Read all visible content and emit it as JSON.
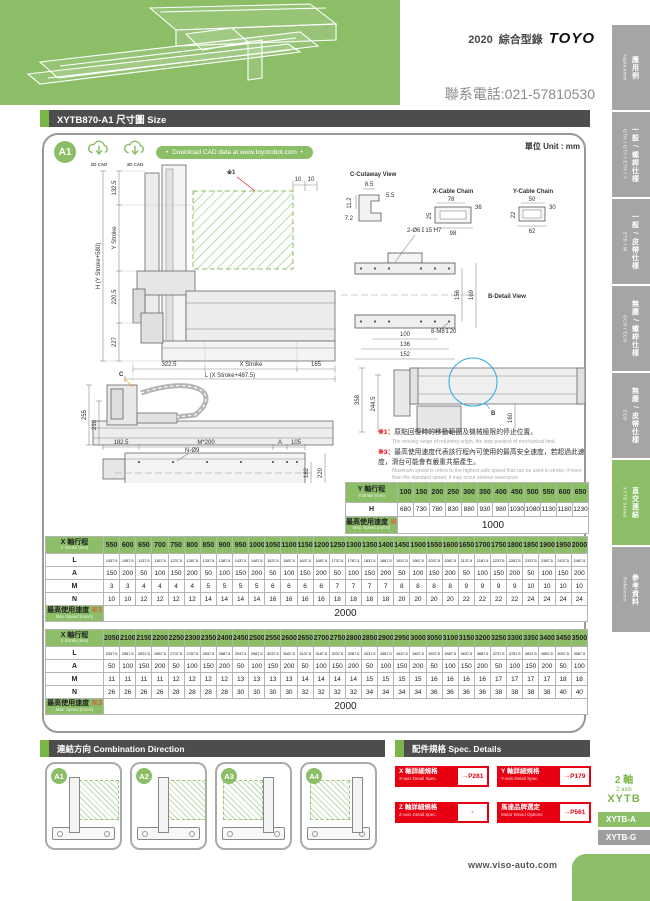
{
  "page": {
    "brand_year": "2020",
    "brand_catalog": "綜合型錄",
    "brand_logo": "TOYO",
    "phone": "聯系電話:021-57810530",
    "footer_url": "www.viso-auto.com"
  },
  "header": {
    "title": "XYTB870-A1 尺寸圖 Size",
    "unit": "單位 Unit : mm",
    "model_badge": "A1",
    "cad_2d": "2D CAD",
    "cad_3d": "3D CAD",
    "download_pill": "Download CAD data at www.toyorobot.com"
  },
  "sidebar": {
    "tabs": [
      {
        "zh": "應用例",
        "en": "Application",
        "active": false
      },
      {
        "zh": "一般 / 螺桿仕樣",
        "en": "GTH / GTY / ETH / Y",
        "active": false
      },
      {
        "zh": "一般 / 皮帶仕樣",
        "en": "ETB / M",
        "active": false
      },
      {
        "zh": "無塵 / 螺桿仕樣",
        "en": "GCH / ECH",
        "active": false
      },
      {
        "zh": "無塵 / 皮帶仕樣",
        "en": "ECB",
        "active": false
      },
      {
        "zh": "直交連結",
        "en": "XYTB Series",
        "active": true
      },
      {
        "zh": "參考資料",
        "en": "Reference",
        "active": false
      }
    ],
    "series_badge": {
      "axis_zh": "2 軸",
      "axis_en": "2 axis",
      "series": "XYTB"
    },
    "series_tabs": [
      {
        "label": "XYTB-A",
        "active": true
      },
      {
        "label": "XYTB-G",
        "active": false
      }
    ]
  },
  "drawings": {
    "front": {
      "ref1": "※1",
      "d10a": "10",
      "d10b": "10",
      "d1325": "132.5",
      "y_stroke": "Y Stroke",
      "h_total": "H (Y Stroke+580)",
      "d2205": "220.5",
      "d227": "227",
      "d3225": "322.5",
      "x_stroke": "X Stroke",
      "d165": "165",
      "l_total": "L (X Stroke+487.5)"
    },
    "cutaway": {
      "title": "C-Cutaway View",
      "d85": "8.5",
      "d55": "5.5",
      "d112": "11.2",
      "d72": "7.2"
    },
    "xchain": {
      "title": "X-Cable Chain",
      "d78": "78",
      "d36": "36",
      "d25": "25",
      "d98": "98"
    },
    "ychain": {
      "title": "Y-Cable Chain",
      "d50": "50",
      "d30": "30",
      "d22": "22",
      "d62": "62"
    },
    "bdetail": {
      "title": "B-Detail View",
      "holes_top": "2-Ø6↧15 H7",
      "holes_bottom": "8-M8↧20",
      "d156": "156",
      "d169": "169",
      "d100": "100",
      "d136": "136",
      "d152": "152"
    },
    "side": {
      "ref": "C",
      "d255": "255",
      "d210": "210"
    },
    "top": {
      "d1825": "182.5",
      "m200a": "M*200",
      "aa": "A",
      "d105": "105",
      "holes_top": "N-Ø9",
      "d182": "182",
      "d220": "220",
      "d2025": "202.5",
      "holes_bottom": "N-M10↧16",
      "m200b": "M*200",
      "ab": "A",
      "d85": "85"
    },
    "sideb": {
      "ref": "B",
      "d358": "358",
      "d2445": "244.5",
      "d160": "160"
    }
  },
  "notes": [
    {
      "ref": "※1",
      "zh": "原點回復時的移動範圍及機械極限的停止位置。",
      "en": "The moving range of returning origin, the stop position of mechanical limit."
    },
    {
      "ref": "※3",
      "zh": "最高使用速度代表該行程內可使用的最高安全速度，若超過此速度，滑台可能會有嚴重共振產生。",
      "en": "Maximum speed is refers to the highest safe speed that can be used in stroke, if more than the standard speed, it may occur serious resonance."
    }
  ],
  "tables": {
    "y_table": {
      "header_zh": "Y 軸行程",
      "header_en": "YStroke (mm)",
      "strokes": [
        100,
        150,
        200,
        250,
        300,
        350,
        400,
        450,
        500,
        550,
        600,
        650
      ],
      "rows": [
        {
          "label": "H",
          "values": [
            680,
            730,
            780,
            830,
            880,
            930,
            980,
            1030,
            1080,
            1130,
            1180,
            1230
          ]
        }
      ],
      "speed_label_zh": "最高使用速度",
      "speed_note": "※3",
      "speed_label_en": "Max. Speed (mm/s)",
      "speed_value": "1000"
    },
    "x_table_1": {
      "header_zh": "X 軸行程",
      "header_en": "X Stroke (mm)",
      "strokes": [
        550,
        600,
        650,
        700,
        750,
        800,
        850,
        900,
        950,
        1000,
        1050,
        1100,
        1150,
        1200,
        1250,
        1300,
        1350,
        1400,
        1450,
        1500,
        1550,
        1600,
        1650,
        1700,
        1750,
        1800,
        1850,
        1900,
        1950,
        2000
      ],
      "rows": [
        {
          "label": "L",
          "values": [
            1037.5,
            1087.5,
            1137.5,
            1187.5,
            1237.5,
            1287.5,
            1337.5,
            1387.5,
            1437.5,
            1487.5,
            1537.5,
            1587.5,
            1637.5,
            1687.5,
            1737.5,
            1787.5,
            1837.5,
            1887.5,
            1937.5,
            1987.5,
            2037.5,
            2087.5,
            2137.5,
            2187.5,
            2237.5,
            2287.5,
            2337.5,
            2387.5,
            2437.5,
            2487.5
          ]
        },
        {
          "label": "A",
          "values": [
            150,
            200,
            50,
            100,
            150,
            200,
            50,
            100,
            150,
            200,
            50,
            100,
            150,
            200,
            50,
            100,
            150,
            200,
            50,
            100,
            150,
            200,
            50,
            100,
            150,
            200,
            50,
            100,
            150,
            200
          ]
        },
        {
          "label": "M",
          "values": [
            3,
            3,
            4,
            4,
            4,
            4,
            5,
            5,
            5,
            5,
            6,
            6,
            6,
            6,
            7,
            7,
            7,
            7,
            8,
            8,
            8,
            8,
            9,
            9,
            9,
            9,
            10,
            10,
            10,
            10
          ]
        },
        {
          "label": "N",
          "values": [
            10,
            10,
            12,
            12,
            12,
            12,
            14,
            14,
            14,
            14,
            16,
            16,
            16,
            16,
            18,
            18,
            18,
            18,
            20,
            20,
            20,
            20,
            22,
            22,
            22,
            22,
            24,
            24,
            24,
            24
          ]
        }
      ],
      "speed_label_zh": "最高使用速度",
      "speed_note": "※3",
      "speed_label_en": "Max. Speed (mm/s)",
      "speed_value": "2000"
    },
    "x_table_2": {
      "header_zh": "X 軸行程",
      "header_en": "X Stroke (mm)",
      "strokes": [
        2050,
        2100,
        2150,
        2200,
        2250,
        2300,
        2350,
        2400,
        2450,
        2500,
        2550,
        2600,
        2650,
        2700,
        2750,
        2800,
        2850,
        2900,
        2950,
        3000,
        3050,
        3100,
        3150,
        3200,
        3250,
        3300,
        3350,
        3400,
        3450,
        3500
      ],
      "rows": [
        {
          "label": "L",
          "values": [
            2537.5,
            2587.5,
            2637.5,
            2687.5,
            2737.5,
            2787.5,
            2837.5,
            2887.5,
            2937.5,
            2987.5,
            3037.5,
            3087.5,
            3137.5,
            3187.5,
            3237.5,
            3287.5,
            3337.5,
            3387.5,
            3437.5,
            3487.5,
            3537.5,
            3587.5,
            3637.5,
            3687.5,
            3737.5,
            3787.5,
            3837.5,
            3887.5,
            3937.5,
            3987.5
          ]
        },
        {
          "label": "A",
          "values": [
            50,
            100,
            150,
            200,
            50,
            100,
            150,
            200,
            50,
            100,
            150,
            200,
            50,
            100,
            150,
            200,
            50,
            100,
            150,
            200,
            50,
            100,
            150,
            200,
            50,
            100,
            150,
            200,
            50,
            100
          ]
        },
        {
          "label": "M",
          "values": [
            11,
            11,
            11,
            11,
            12,
            12,
            12,
            12,
            13,
            13,
            13,
            13,
            14,
            14,
            14,
            14,
            15,
            15,
            15,
            15,
            16,
            16,
            16,
            16,
            17,
            17,
            17,
            17,
            18,
            18
          ]
        },
        {
          "label": "N",
          "values": [
            26,
            26,
            26,
            26,
            28,
            28,
            28,
            28,
            30,
            30,
            30,
            30,
            32,
            32,
            32,
            32,
            34,
            34,
            34,
            34,
            36,
            36,
            36,
            36,
            38,
            38,
            38,
            38,
            40,
            40
          ]
        }
      ],
      "speed_label_zh": "最高使用速度",
      "speed_note": "※3",
      "speed_label_en": "Max. Speed (mm/s)",
      "speed_value": "2000"
    }
  },
  "combination": {
    "title_zh": "連結方向",
    "title_en": "Combination Direction",
    "options": [
      {
        "label": "A1"
      },
      {
        "label": "A2"
      },
      {
        "label": "A3"
      },
      {
        "label": "A4"
      }
    ]
  },
  "spec_details": {
    "title_zh": "配件規格",
    "title_en": "Spec. Details",
    "items": [
      {
        "zh": "X 軸詳細規格",
        "en": "X-axis Detail Spec.",
        "page": "→P281"
      },
      {
        "zh": "Y 軸詳細規格",
        "en": "Y-axis Detail Spec.",
        "page": "→P179"
      },
      {
        "zh": "Z 軸詳細規格",
        "en": "Z-axis Detail Spec.",
        "page": "-"
      },
      {
        "zh": "馬達品牌選定",
        "en": "Motor Brand Options",
        "page": "→P561"
      }
    ]
  },
  "colors": {
    "green": "#8CBE68",
    "dark": "#4D4D4D",
    "red": "#E60012",
    "orange": "#F39800",
    "blue": "#29ABE2"
  }
}
